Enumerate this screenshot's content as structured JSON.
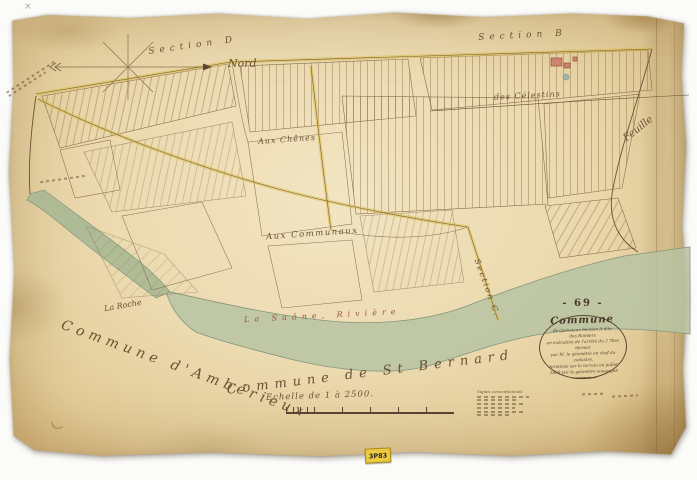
{
  "compass": {
    "north": "Nord"
  },
  "labels": {
    "section_d": "Section   D",
    "section_b": "Section   B",
    "section_c": "Section C.",
    "feuille": "Feuille",
    "celestins": "des Célestins",
    "chenes": "Aux Chênes",
    "communaux": "Aux Communaux",
    "roche": "La Roche",
    "river": "La Saône,  Rivière"
  },
  "neighbors": {
    "west": "Commune  d'Ambérieux",
    "south": "Commune  de  St  Bernard"
  },
  "cartouche": {
    "number": "- 69 -",
    "title": "Commune",
    "line1": "de Quincieux   Section A dite",
    "line2": "des   Ramiers",
    "line3": "en exécution de l'arrêté du 2 7bre dernier",
    "line4": "par M. le géomètre en chef du cadastre,",
    "line5": "terminée sur le terrain en juillet",
    "line6": "1839 par le géomètre soussigné"
  },
  "scale": {
    "label": "Echelle de 1 à 2500."
  },
  "legend": {
    "title": "Signes conventionnels"
  },
  "archive": {
    "sticker": "3P83"
  }
}
